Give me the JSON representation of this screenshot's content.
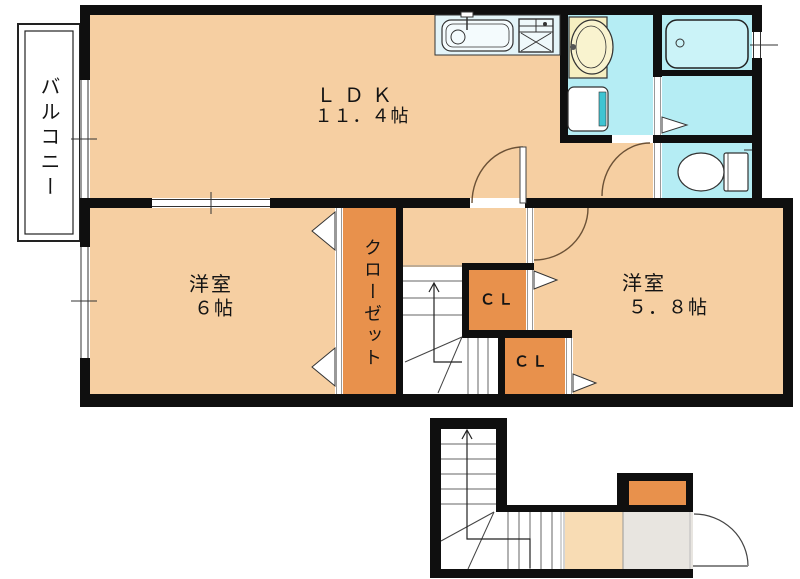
{
  "plan": {
    "title": "apartment-floor-plan",
    "balcony": {
      "label": "バルコニー"
    },
    "ldk": {
      "name": "ＬＤＫ",
      "size": "１１．４帖"
    },
    "bedroom_6": {
      "name": "洋室",
      "size": "６帖"
    },
    "closet": {
      "label": "クローゼット"
    },
    "closet_upper": {
      "label": "ＣＬ"
    },
    "closet_lower": {
      "label": "ＣＬ"
    },
    "bedroom_58": {
      "name": "洋室",
      "size": "５．８帖"
    }
  },
  "colors": {
    "room_fill": "#F6CFA2",
    "closet_fill": "#E8914C",
    "wet_area_fill": "#B5EDF4",
    "bathtub_fill": "#CBF3F8",
    "kitchen_counter_fill": "#E3F4F8",
    "vanity_fill": "#F6EFC1",
    "washer_stripe": "#3FC4D2",
    "entry_hall_fill": "#F8DCB4",
    "entry_floor_fill": "#E8E5E0",
    "wall": "#0F0F0F"
  }
}
